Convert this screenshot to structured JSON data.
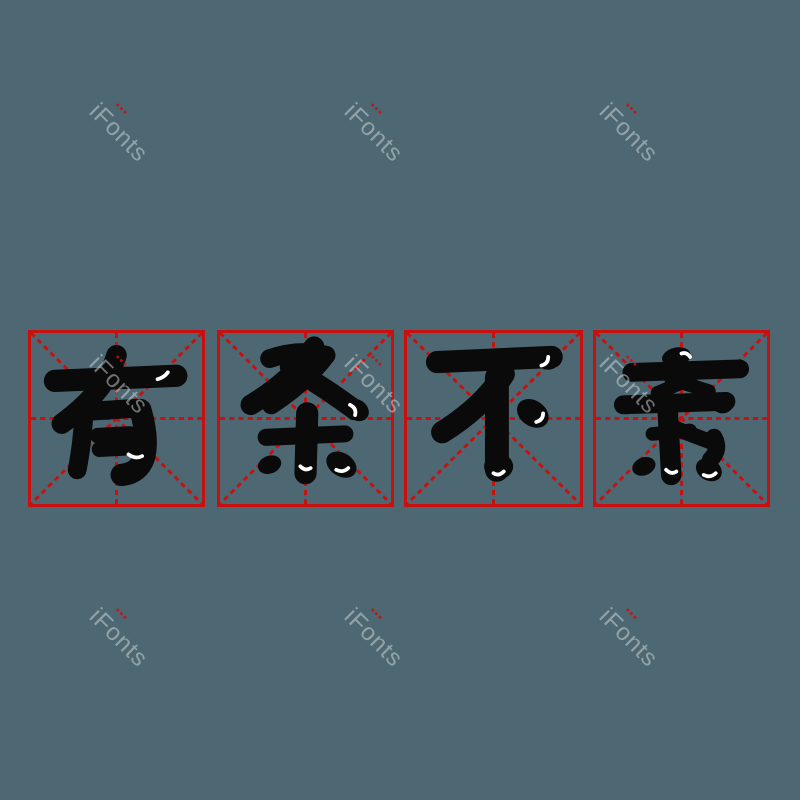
{
  "canvas": {
    "width": 800,
    "height": 800,
    "background_color": "#4d6872"
  },
  "idiom": {
    "text": "有条不紊",
    "characters": [
      "有",
      "条",
      "不",
      "紊"
    ]
  },
  "grid": {
    "style": "mi-zi-ge practice squares",
    "box_count": 4,
    "line_color": "#c8100e",
    "glyph_color": "#0a0a0a",
    "highlight_color": "#ffffff"
  },
  "watermark": {
    "text": "iFonts",
    "color": "rgba(220,227,228,0.48)",
    "dot_color": "#c8100e",
    "rotation_deg": 45,
    "positions": [
      [
        103,
        98
      ],
      [
        358,
        98
      ],
      [
        613,
        98
      ],
      [
        103,
        350
      ],
      [
        358,
        350
      ],
      [
        613,
        350
      ],
      [
        103,
        603
      ],
      [
        358,
        603
      ],
      [
        613,
        603
      ]
    ]
  }
}
